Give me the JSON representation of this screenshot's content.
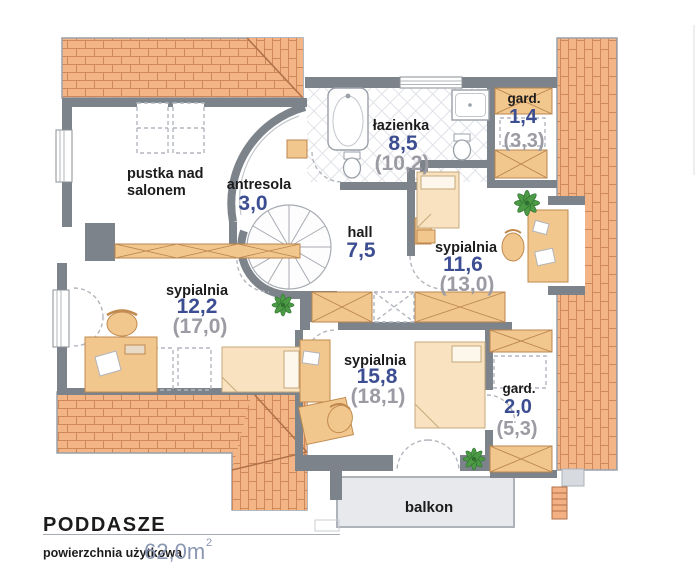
{
  "rooms": {
    "pustka": {
      "line1": "pustka nad",
      "line2": "salonem"
    },
    "antresola": {
      "name": "antresola",
      "area": "3,0"
    },
    "lazienka": {
      "name": "łazienka",
      "area": "8,5",
      "gross": "(10,2)"
    },
    "gard_top": {
      "name": "gard.",
      "area": "1,4",
      "gross": "(3,3)"
    },
    "hall": {
      "name": "hall",
      "area": "7,5"
    },
    "sypialnia_right": {
      "name": "sypialnia",
      "area": "11,6",
      "gross": "(13,0)"
    },
    "sypialnia_left": {
      "name": "sypialnia",
      "area": "12,2",
      "gross": "(17,0)"
    },
    "sypialnia_bottom": {
      "name": "sypialnia",
      "area": "15,8",
      "gross": "(18,1)"
    },
    "gard_bottom": {
      "name": "gard.",
      "area": "2,0",
      "gross": "(5,3)"
    },
    "balkon": {
      "name": "balkon"
    }
  },
  "footer": {
    "title": "PODDASZE",
    "area_label": "powierzchnia użytkowa",
    "area_value": "62,0m",
    "area_exponent": "2"
  },
  "colors": {
    "roof": "#f3b486",
    "roof_joint": "#cd8759",
    "wall": "#7d838b",
    "window_wood": "#f2c78e",
    "furniture_cream": "#f9e2c0",
    "area_blue": "#3c4e91",
    "gross_gray": "#9b9ba3",
    "balcony_gray": "#e7e9ec",
    "plant_green": "#4c9a45"
  }
}
